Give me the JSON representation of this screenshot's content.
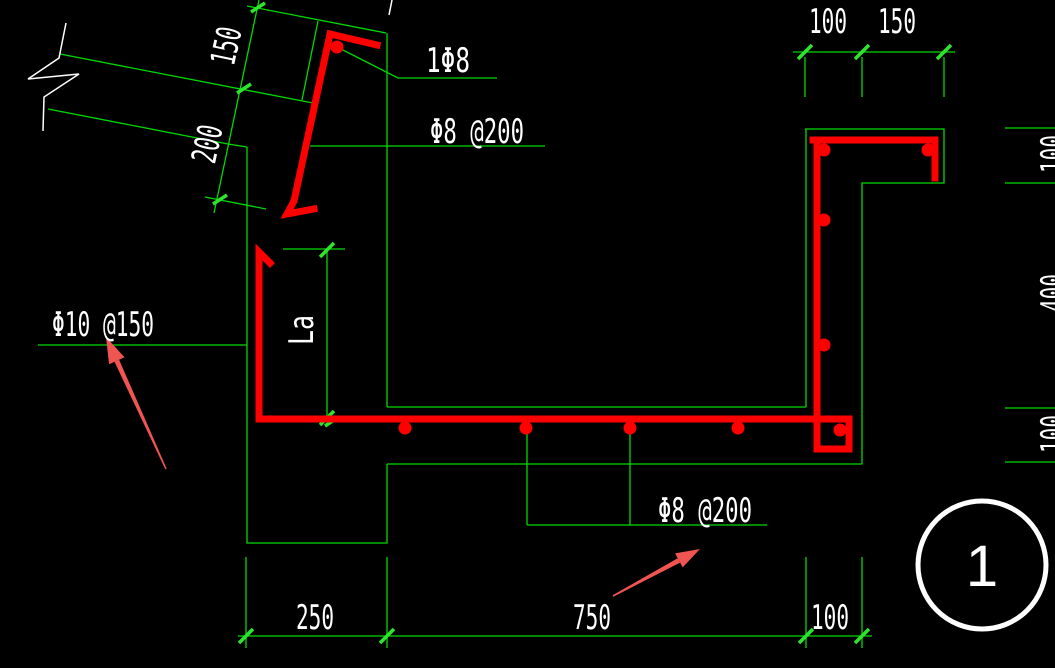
{
  "drawing": {
    "type": "reinforcement-detail-section",
    "detail_number": "1",
    "labels": {
      "corner_bar": "1Φ8",
      "slope_distribution": "Φ8 @200",
      "main_bar": "Φ10 @150",
      "slab_distribution": "Φ8 @200",
      "anchorage": "La"
    },
    "dimensions": {
      "slope": [
        "150",
        "200"
      ],
      "top": [
        "100",
        "150"
      ],
      "bottom": [
        "250",
        "750",
        "100"
      ],
      "right": [
        "100",
        "400",
        "100"
      ]
    },
    "colors": {
      "background": "#000000",
      "drawing_line": "#00d900",
      "tick_mark": "#2de52d",
      "rebar": "#ff0000",
      "callout_arrow": "#f15552",
      "text": "#ffffff"
    }
  }
}
